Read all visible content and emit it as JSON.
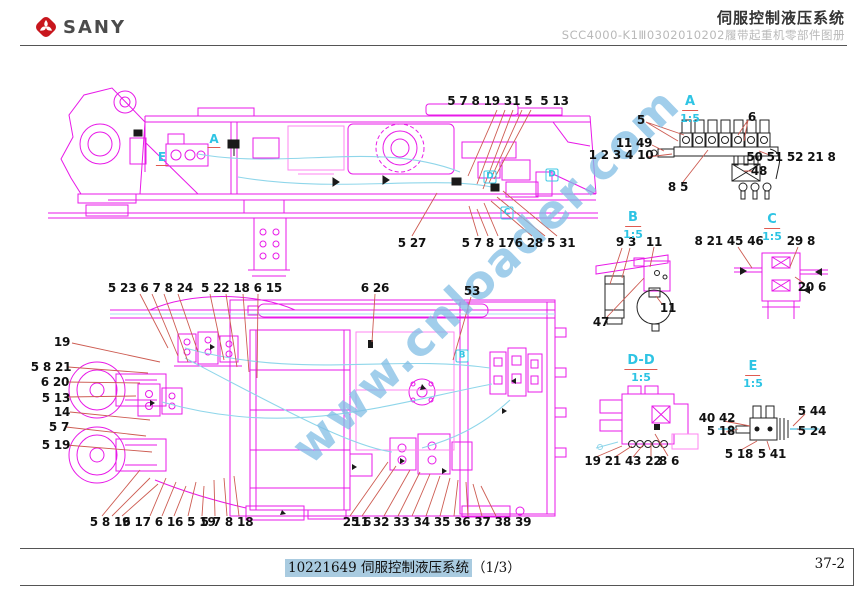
{
  "header": {
    "brand": "SANY",
    "title": "伺服控制液压系统",
    "subtitle": "SCC4000-K1Ⅲ0302010202履带起重机零部件图册"
  },
  "watermark": {
    "text": "www.cnloader.com"
  },
  "footer": {
    "doc_number": "10221649",
    "doc_title": "伺服控制液压系统",
    "sheet_index": "（1/3）",
    "page_number": "37-2"
  },
  "colors": {
    "drawing_magenta": "#e81ae8",
    "drawing_pink": "#ff85f2",
    "hose_cyan": "#8fd6ea",
    "label_cyan": "#2ec4e4",
    "leader_red": "#cd5c52",
    "callout_black": "#111111",
    "highlight_blue": "#a9cbe0",
    "logo_red": "#c8161d"
  },
  "detail_views": [
    {
      "label": "A",
      "scale": "1:5",
      "x": 690,
      "y": 90
    },
    {
      "label": "B",
      "scale": "1:5",
      "x": 633,
      "y": 206
    },
    {
      "label": "C",
      "scale": "1:5",
      "x": 772,
      "y": 208
    },
    {
      "label": "D-D",
      "scale": "1:5",
      "x": 641,
      "y": 349
    },
    {
      "label": "E",
      "scale": "1:5",
      "x": 753,
      "y": 355
    }
  ],
  "section_markers": [
    {
      "label": "A",
      "x": 214,
      "y": 140,
      "underline": true,
      "boxed": false
    },
    {
      "label": "E",
      "x": 162,
      "y": 158,
      "underline": true,
      "boxed": false
    },
    {
      "label": "D",
      "x": 490,
      "y": 177,
      "underline": false,
      "boxed": true
    },
    {
      "label": "D",
      "x": 552,
      "y": 175,
      "underline": false,
      "boxed": true
    },
    {
      "label": "C",
      "x": 507,
      "y": 213,
      "underline": false,
      "boxed": true
    },
    {
      "label": "B",
      "x": 462,
      "y": 356,
      "underline": false,
      "boxed": true
    }
  ],
  "callouts": [
    {
      "text": "5 7 8 19 31 5  5 13",
      "x": 508,
      "y": 101
    },
    {
      "text": "5 27",
      "x": 412,
      "y": 243
    },
    {
      "text": "5 7 8 17",
      "x": 488,
      "y": 243
    },
    {
      "text": "6 28 5 31",
      "x": 545,
      "y": 243
    },
    {
      "text": "5",
      "x": 641,
      "y": 120
    },
    {
      "text": "6",
      "x": 752,
      "y": 117
    },
    {
      "text": "11 49",
      "x": 634,
      "y": 143
    },
    {
      "text": "1 2 3 4 10",
      "x": 621,
      "y": 155
    },
    {
      "text": "50 51 52 21 8",
      "x": 791,
      "y": 157
    },
    {
      "text": "48",
      "x": 759,
      "y": 171
    },
    {
      "text": "8 5",
      "x": 678,
      "y": 187
    },
    {
      "text": "9 3",
      "x": 626,
      "y": 242
    },
    {
      "text": "11",
      "x": 654,
      "y": 242
    },
    {
      "text": "11",
      "x": 668,
      "y": 308
    },
    {
      "text": "47",
      "x": 601,
      "y": 322
    },
    {
      "text": "8 21 45 46",
      "x": 729,
      "y": 241
    },
    {
      "text": "29 8",
      "x": 801,
      "y": 241
    },
    {
      "text": "20 6",
      "x": 812,
      "y": 287
    },
    {
      "text": "19 21 43 22",
      "x": 623,
      "y": 461
    },
    {
      "text": "8 6",
      "x": 669,
      "y": 461
    },
    {
      "text": "40 42",
      "x": 717,
      "y": 418
    },
    {
      "text": "5 18",
      "x": 721,
      "y": 431
    },
    {
      "text": "5 44",
      "x": 812,
      "y": 411
    },
    {
      "text": "5 24",
      "x": 812,
      "y": 431
    },
    {
      "text": "5 18",
      "x": 739,
      "y": 454
    },
    {
      "text": "5 41",
      "x": 772,
      "y": 454
    },
    {
      "text": "5 23 6 7 8 24  5 22 18 6 15",
      "x": 195,
      "y": 288
    },
    {
      "text": "6 26",
      "x": 375,
      "y": 288
    },
    {
      "text": "53",
      "x": 472,
      "y": 291
    },
    {
      "text": "19",
      "x": 62,
      "y": 342
    },
    {
      "text": "5 8 21",
      "x": 51,
      "y": 367
    },
    {
      "text": "6 20",
      "x": 55,
      "y": 382
    },
    {
      "text": "5 13",
      "x": 56,
      "y": 398
    },
    {
      "text": "14",
      "x": 62,
      "y": 412
    },
    {
      "text": "5 7",
      "x": 59,
      "y": 427
    },
    {
      "text": "5 19",
      "x": 56,
      "y": 445
    },
    {
      "text": "5 8 19",
      "x": 110,
      "y": 522
    },
    {
      "text": "6 17 6 16 5 19",
      "x": 169,
      "y": 522
    },
    {
      "text": "5 7 8 18",
      "x": 227,
      "y": 522
    },
    {
      "text": "25 6",
      "x": 357,
      "y": 522
    },
    {
      "text": "11 32 33 34 35 36 37 38 39",
      "x": 442,
      "y": 522
    }
  ]
}
